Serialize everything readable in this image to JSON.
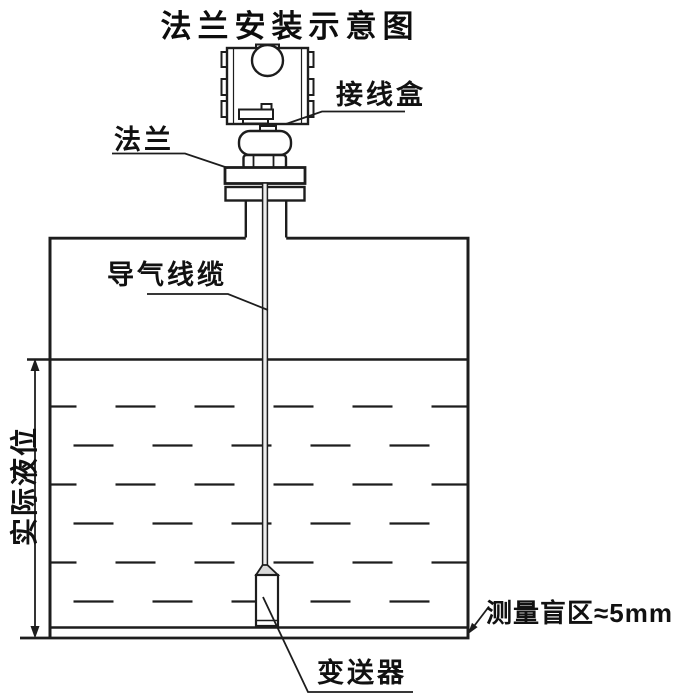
{
  "diagram": {
    "title": "法兰安装示意图",
    "labels": {
      "junction_box": "接线盒",
      "flange": "法兰",
      "air_cable": "导气线缆",
      "actual_level": "实际液位",
      "blind_zone": "测量盲区≈5mm",
      "transmitter": "变送器"
    },
    "colors": {
      "line": "#1d1d1d",
      "background": "#ffffff",
      "cable_fill": "#ededed"
    }
  }
}
